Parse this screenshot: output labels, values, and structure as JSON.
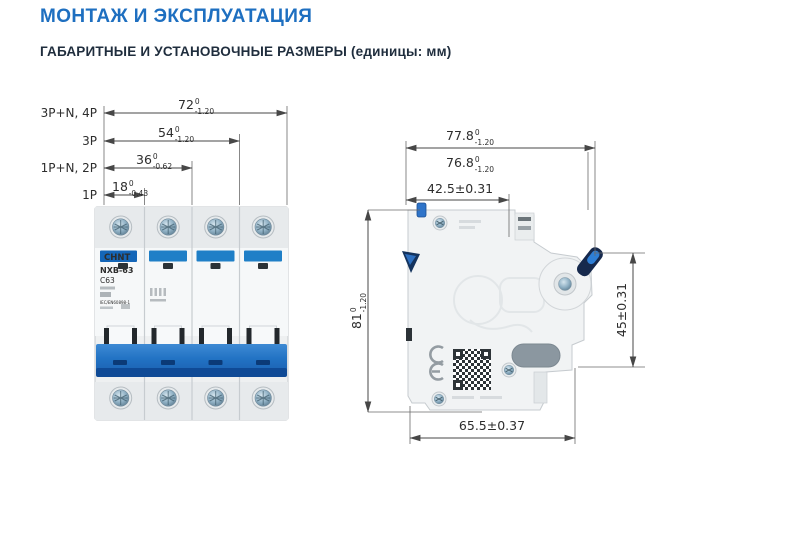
{
  "page": {
    "title": "МОНТАЖ И ЭКСПЛУАТАЦИЯ",
    "subtitle": "ГАБАРИТНЫЕ И УСТАНОВОЧНЫЕ РАЗМЕРЫ (единицы: мм)"
  },
  "colors": {
    "title_blue": "#1e6fc0",
    "subtitle_dark": "#1f2d3d",
    "breaker_blue": "#2176c7",
    "dimension_line": "#474747"
  },
  "front_view": {
    "rows": [
      {
        "label": "3P+N, 4P",
        "value": "72",
        "tol_upper": "0",
        "tol_lower": "-1.20"
      },
      {
        "label": "3P",
        "value": "54",
        "tol_upper": "0",
        "tol_lower": "-1.20"
      },
      {
        "label": "1P+N, 2P",
        "value": "36",
        "tol_upper": "0",
        "tol_lower": "-0.62"
      },
      {
        "label": "1P",
        "value": "18",
        "tol_upper": "0",
        "tol_lower": "-0.43"
      }
    ],
    "device": {
      "brand": "CHNT",
      "model": "NXB-63",
      "rating": "C63",
      "standard": "IEC/EN60898-1"
    }
  },
  "side_view": {
    "dim_depth_total": {
      "value": "77.8",
      "tol_upper": "0",
      "tol_lower": "-1.20"
    },
    "dim_depth_body": {
      "value": "76.8",
      "tol_upper": "0",
      "tol_lower": "-1.20"
    },
    "dim_rail": "42.5±0.31",
    "dim_height": {
      "value": "81",
      "tol_upper": "0",
      "tol_lower": "-1.20"
    },
    "dim_recess": "45±0.31",
    "dim_bottom": "65.5±0.37",
    "ce_mark": "CE"
  }
}
